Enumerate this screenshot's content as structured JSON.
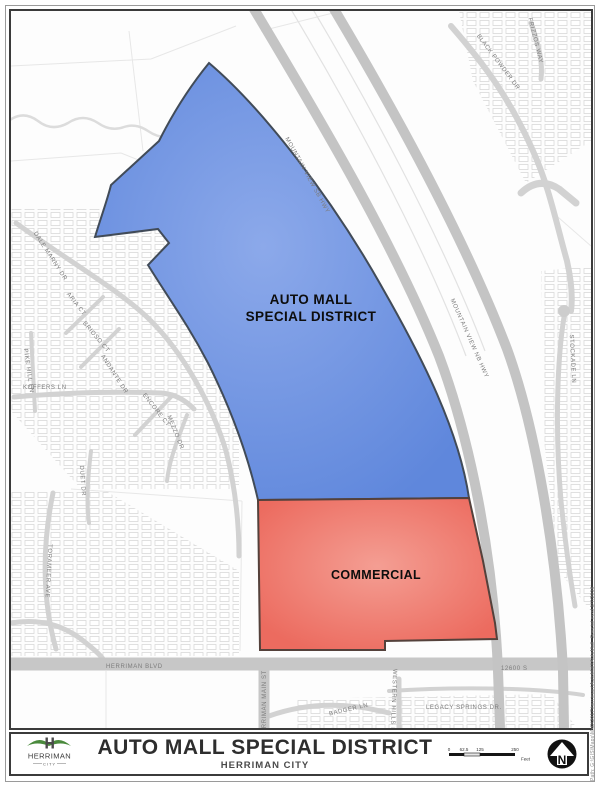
{
  "map": {
    "district_line1": "AUTO MALL",
    "district_line2": "SPECIAL DISTRICT",
    "commercial_label": "COMMERCIAL",
    "streets": {
      "mountain_view_sb": "MOUNTAIN VIEW SB HWY",
      "mountain_view_nb": "MOUNTAIN VIEW NB HWY",
      "black_powder": "BLACK POWDER DR",
      "frizzos": "FRIZZOS WAY",
      "stockade": "STOCKADE LN",
      "dale_marny": "DALE MARNY DR",
      "aria": "ARIA CT",
      "brioso": "BRIOSO CT",
      "andante": "ANDANTE DR",
      "pike_hill": "PIKE HILL LN",
      "koffers": "KOFFERS LN",
      "encore": "ENCORE CT",
      "mezzo": "MEZZO DR",
      "duet": "DUET DR",
      "toromeer": "TORAMEER AVE",
      "herriman_blvd": "HERRIMAN BLVD",
      "herriman_main": "HERRIMAN MAIN ST",
      "s12600": "12600 S",
      "badger": "BADGER LN",
      "legacy_springs": "LEGACY SPRINGS DR.",
      "western_hills": "WESTERN HILLS DR"
    },
    "colors": {
      "auto_mall_fill": "#6b8fdf",
      "auto_mall_fill_light": "#8ca9ea",
      "auto_mall_stroke": "#414b58",
      "commercial_fill": "#ec6b5f",
      "commercial_fill_light": "#f49e93",
      "commercial_stroke": "#54413b",
      "road_major": "#c7c7c7",
      "road_minor": "#d6d6d6",
      "parcel_line": "#dfdfdf"
    }
  },
  "footer": {
    "title": "AUTO MALL SPECIAL DISTRICT",
    "subtitle": "HERRIMAN CITY",
    "logo_name": "HERRIMAN",
    "logo_sub": "CITY",
    "north_label": "N",
    "scale": {
      "t0": "0",
      "t1": "62.5",
      "t2": "125",
      "t3": "250",
      "unit": "Feet"
    }
  },
  "margin_note": "Path: G:\\GIS\\Maps\\MxD\\2017\\herriman\\AutoMall\\AutoMall_Special.mxd    1/7/2016"
}
